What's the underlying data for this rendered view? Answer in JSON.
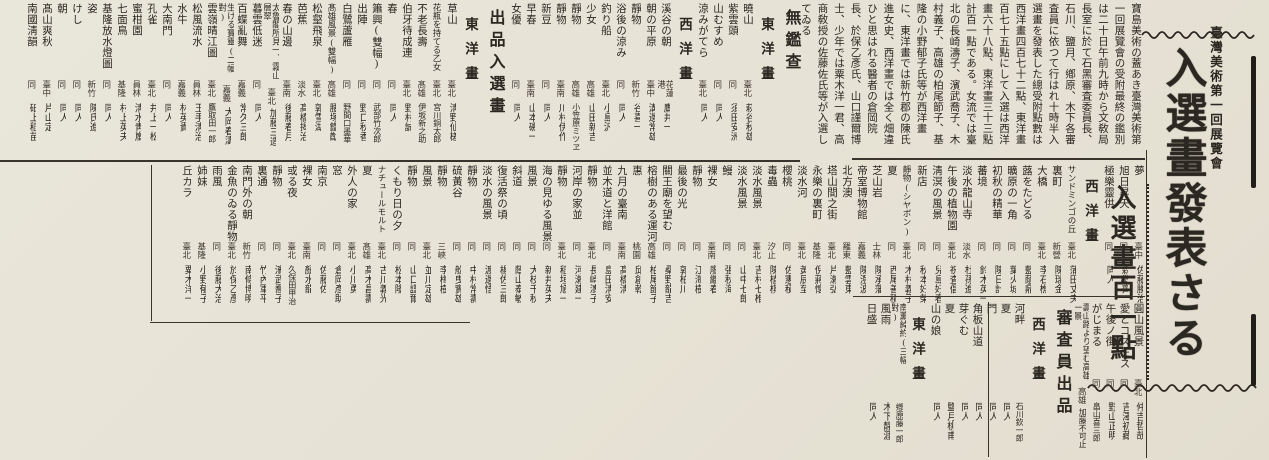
{
  "colors": {
    "paper": "#e8e4d8",
    "ink": "#2b2721"
  },
  "title_block": {
    "kicker": "臺灣美術第一回展覽會",
    "main_title": "入選畫發表さる",
    "sub_title": "入選畫百一點"
  },
  "lead": {
    "text": "寶島美術の蓋あき臺灣美術第一回展覽會の受附最終の鑑別は二十日午前九時から文敎局長室に於て石黑審査委員長、石川、鹽月、鄕原、木下各審査員に依つて行はれ十時半入選畫を發表した總受附點數は西洋畫四百七十二點、東洋畫百七十五點にして入選は西洋畫六十八點、東洋畫三十三點計百一點である。女流では臺北の長崎濤子、濱武喬子、木村義子、高雄の柏尾節子、基隆の小野郁子氏等が西洋畫に、東洋畫では新竹郡の陳氏進女史、西洋畫では全く畑違ひと思はれる醫者の倉岡院長、於保乙彥氏、山口謹爾博士、少年では粟木洋一君、高商敎授の佐藤佐氏等が入選してゐる"
  },
  "bands": {
    "top": [
      {
        "k": "h1",
        "text": "無鑑查"
      },
      {
        "k": "h2",
        "text": "東洋畫"
      },
      {
        "k": "e",
        "t": "曉山",
        "p": "臺北",
        "n": "萩谷秋雄"
      },
      {
        "k": "e",
        "t": "紫雲頭",
        "p": "同",
        "n": "須田安洲"
      },
      {
        "k": "e",
        "t": "山むすめ",
        "p": "同",
        "n": "同人"
      },
      {
        "k": "e",
        "t": "涼みがてら",
        "p": "臺北",
        "n": "同人"
      },
      {
        "k": "h2",
        "text": "西洋畫"
      },
      {
        "k": "e",
        "t": "溪谷の朝",
        "p": "花蓮港",
        "n": "鷹井一"
      },
      {
        "k": "e",
        "t": "朝の平原",
        "p": "臺中",
        "n": "溝邊常雄"
      },
      {
        "k": "e",
        "t": "靜物",
        "p": "新竹",
        "n": "谷喜一"
      },
      {
        "k": "e",
        "t": "浴後の涼み",
        "p": "同",
        "n": "同人"
      },
      {
        "k": "e",
        "t": "釣り船",
        "p": "臺北",
        "n": "小島汎"
      },
      {
        "k": "e",
        "t": "少女",
        "p": "高雄",
        "n": "山田新吉"
      },
      {
        "k": "e",
        "t": "靜物",
        "p": "高雄",
        "n": "小笠原ミツヱ"
      },
      {
        "k": "e",
        "t": "靜物",
        "p": "臺南",
        "n": "川村伊作"
      },
      {
        "k": "e",
        "t": "新豆",
        "p": "同",
        "n": "同人"
      },
      {
        "k": "e",
        "t": "早春",
        "p": "臺南",
        "n": "山本磯一"
      },
      {
        "k": "e",
        "t": "女優",
        "p": "同",
        "n": "同人"
      },
      {
        "k": "h1",
        "text": "出品入選畫"
      },
      {
        "k": "h2",
        "text": "東洋畫"
      },
      {
        "k": "e",
        "t": "草山",
        "p": "臺北",
        "n": "淸野仙槎"
      },
      {
        "k": "e",
        "t": "花瓶を持てる乙女",
        "p": "臺北",
        "n": "宮川銅太郎"
      },
      {
        "k": "e",
        "t": "不老長壽",
        "p": "髙雄",
        "n": "伊坂新之助"
      },
      {
        "k": "e",
        "t": "伯牙待成連",
        "p": "臺北",
        "n": "野村誠"
      },
      {
        "k": "e",
        "t": "春",
        "p": "同",
        "n": "同人"
      },
      {
        "k": "e",
        "t": "簫興(雙幅)",
        "p": "同",
        "n": "武部竹次郎"
      },
      {
        "k": "e",
        "t": "出陣",
        "p": "同",
        "n": "野口秋香"
      },
      {
        "k": "e",
        "t": "白鷺蘆雁",
        "p": "同",
        "n": "野間口墨華"
      },
      {
        "k": "e",
        "t": "髙雄風景(雙幅)",
        "p": "高雄",
        "n": "腰塚鐵猷"
      },
      {
        "k": "e",
        "t": "松壑飛泉",
        "p": "臺北",
        "n": "郭雪湖"
      },
      {
        "k": "e",
        "t": "芭蕉",
        "p": "淡水",
        "n": "髙橋揭治"
      },
      {
        "k": "e",
        "t": "春の山邊",
        "p": "臺南",
        "n": "後藤春月"
      },
      {
        "k": "e",
        "t": "太魯閣所見一、霧山層翠",
        "p": "臺北",
        "n": "加藤三造"
      },
      {
        "k": "e",
        "t": "暮雲低迷",
        "p": "同",
        "n": "同人"
      },
      {
        "k": "e",
        "t": "百蝶亂舞",
        "p": "嘉義",
        "n": "常久三郎"
      },
      {
        "k": "e",
        "t": "生ける寶靈(二幅對)",
        "p": "嘉義",
        "n": "大岡春濤"
      },
      {
        "k": "e",
        "t": "雲嶺晴江圖",
        "p": "臺北",
        "n": "鷹取田一郎"
      },
      {
        "k": "e",
        "t": "松風流水",
        "p": "員林",
        "n": "玉手淸治"
      },
      {
        "k": "e",
        "t": "水牛",
        "p": "嘉義",
        "n": "林英貴"
      },
      {
        "k": "e",
        "t": "大南門",
        "p": "同",
        "n": "同人"
      },
      {
        "k": "e",
        "t": "孔雀",
        "p": "臺北",
        "n": "井上一松"
      },
      {
        "k": "e",
        "t": "蜜柑園",
        "p": "員林",
        "n": "淸水靑嵐"
      },
      {
        "k": "e",
        "t": "七面鳥",
        "p": "基隆",
        "n": "村上英夫"
      },
      {
        "k": "e",
        "t": "基隆放水燈圖",
        "p": "同",
        "n": "同人"
      },
      {
        "k": "e",
        "t": "姿",
        "p": "新竹",
        "n": "陳氏進"
      },
      {
        "k": "e",
        "t": "けし",
        "p": "同",
        "n": "同人"
      },
      {
        "k": "e",
        "t": "朝",
        "p": "同",
        "n": "同人"
      },
      {
        "k": "e",
        "t": "髙山爽秋",
        "p": "臺中",
        "n": "片山定"
      },
      {
        "k": "e",
        "t": "南國淸韻",
        "p": "同",
        "n": "砥上稻苗"
      }
    ],
    "middle": [
      {
        "k": "e",
        "t": "夢",
        "p": "臺中",
        "n": "佐藤勝治"
      },
      {
        "k": "e",
        "t": "旭日昇天",
        "p": "同",
        "n": "森敎齊"
      },
      {
        "k": "e",
        "t": "極樂靈供",
        "p": "同",
        "n": "同人"
      },
      {
        "k": "h2",
        "text": "西洋畫"
      },
      {
        "k": "e",
        "t": "サンドミンゴの丘",
        "p": "臺北",
        "n": "蒲田丈夫"
      },
      {
        "k": "e",
        "t": "裏町",
        "p": "新營",
        "n": "陳瑞金"
      },
      {
        "k": "e",
        "t": "大橋",
        "p": "臺北",
        "n": "李石樵"
      },
      {
        "k": "e",
        "t": "蕗をたどる",
        "p": "同",
        "n": "藍蔭鼎"
      },
      {
        "k": "e",
        "t": "曠原の一角",
        "p": "同",
        "n": "葉火城"
      },
      {
        "k": "e",
        "t": "初秋の精華",
        "p": "同",
        "n": "陳日計"
      },
      {
        "k": "e",
        "t": "蕃境",
        "p": "同",
        "n": "鈴木英一"
      },
      {
        "k": "e",
        "t": "淡水龍山寺",
        "p": "淡水",
        "n": "杜孫進"
      },
      {
        "k": "e",
        "t": "午後の植物園",
        "p": "臺北",
        "n": "祝査倡"
      },
      {
        "k": "e",
        "t": "淸溟の風景",
        "p": "同",
        "n": "兒島好春"
      },
      {
        "k": "e",
        "t": "新店",
        "p": "同",
        "n": "秋本好榮"
      },
      {
        "k": "e",
        "t": "靜物(シヤボン)",
        "p": "臺北",
        "n": "木村義子"
      },
      {
        "k": "e",
        "t": "夏",
        "p": "同",
        "n": "西尾善積"
      },
      {
        "k": "e",
        "t": "芝山岩",
        "p": "士林",
        "n": "陳承藩"
      },
      {
        "k": "e",
        "t": "帝室博物館",
        "p": "嘉義",
        "n": "陳澄波"
      },
      {
        "k": "e",
        "t": "北方澳",
        "p": "羅東",
        "n": "藍雲東"
      },
      {
        "k": "e",
        "t": "塔山間之街",
        "p": "臺北",
        "n": "片瀨弘"
      },
      {
        "k": "e",
        "t": "永樂の裏町",
        "p": "基隆",
        "n": "倪蔣懷"
      },
      {
        "k": "e",
        "t": "淡水河",
        "p": "臺北",
        "n": "黃辰至"
      },
      {
        "k": "e",
        "t": "櫻桃",
        "p": "同",
        "n": "佐憲積"
      },
      {
        "k": "e",
        "t": "毒蟲",
        "p": "汐止",
        "n": "陳植棋"
      },
      {
        "k": "e",
        "t": "淡水風景",
        "p": "臺北",
        "n": "吉村七椎"
      },
      {
        "k": "e",
        "t": "淡水風景",
        "p": "同",
        "n": "山中七郎"
      },
      {
        "k": "e",
        "t": "鰻",
        "p": "同",
        "n": "張秋海"
      },
      {
        "k": "e",
        "t": "裸女",
        "p": "臺南",
        "n": "廖繼春"
      },
      {
        "k": "e",
        "t": "靜物",
        "p": "同",
        "n": "江海樹"
      },
      {
        "k": "e",
        "t": "最後の光",
        "p": "同",
        "n": "郭柏川"
      },
      {
        "k": "e",
        "t": "關王廟を望む",
        "p": "同",
        "n": "桑野龍吉"
      },
      {
        "k": "e",
        "t": "榕樹のある運河",
        "p": "高雄",
        "n": "柏尾節子"
      },
      {
        "k": "e",
        "t": "惠",
        "p": "桃園",
        "n": "邱創乾"
      },
      {
        "k": "e",
        "t": "九月の臺南",
        "p": "臺南",
        "n": "髙橋淸"
      },
      {
        "k": "e",
        "t": "並木道と洋館",
        "p": "同",
        "n": "島田淸安"
      },
      {
        "k": "e",
        "t": "靜物",
        "p": "臺北",
        "n": "長崎濤子"
      },
      {
        "k": "e",
        "t": "河岸の家並",
        "p": "同",
        "n": "河瀨建一"
      },
      {
        "k": "e",
        "t": "靜物",
        "p": "臺北",
        "n": "稻垣馗一"
      },
      {
        "k": "e",
        "t": "海の見ゆる風景",
        "p": "同",
        "n": "新井英夫"
      },
      {
        "k": "e",
        "t": "風景",
        "p": "同",
        "n": "大枝千秋"
      },
      {
        "k": "e",
        "t": "斜道",
        "p": "同",
        "n": "蔭山泰敏"
      },
      {
        "k": "e",
        "t": "復活祭の頃",
        "p": "同",
        "n": "楊佐三郎"
      },
      {
        "k": "e",
        "t": "淡水の風景",
        "p": "同",
        "n": "渡邊悟"
      },
      {
        "k": "e",
        "t": "靜物",
        "p": "同",
        "n": "中村常壽"
      },
      {
        "k": "e",
        "t": "硫黃谷",
        "p": "同",
        "n": "舩曳實雄"
      },
      {
        "k": "e",
        "t": "靜物",
        "p": "三峽",
        "n": "李梅樹"
      },
      {
        "k": "e",
        "t": "風景",
        "p": "臺北",
        "n": "並川定雄"
      },
      {
        "k": "e",
        "t": "靜物",
        "p": "同",
        "n": "山口謹爾"
      },
      {
        "k": "e",
        "t": "くもり日の夕",
        "p": "同",
        "n": "松本隆"
      },
      {
        "k": "e",
        "t": "ナチュールモルト",
        "p": "臺北",
        "n": "古川義光"
      },
      {
        "k": "e",
        "t": "夏",
        "p": "髙雄",
        "n": "髙木昌壽"
      },
      {
        "k": "e",
        "t": "外人の家",
        "p": "臺北",
        "n": "小川勇"
      },
      {
        "k": "e",
        "t": "窓",
        "p": "同",
        "n": "倉岡彥助"
      },
      {
        "k": "e",
        "t": "南京",
        "p": "同",
        "n": "佐藤佐"
      },
      {
        "k": "e",
        "t": "裸女",
        "p": "臺南",
        "n": "顏水龍"
      },
      {
        "k": "e",
        "t": "或る夜",
        "p": "臺北",
        "n": "久保田甲治"
      },
      {
        "k": "e",
        "t": "靜物",
        "p": "同",
        "n": "濱武喬子"
      },
      {
        "k": "e",
        "t": "裏通",
        "p": "同",
        "n": "竹內軍平"
      },
      {
        "k": "e",
        "t": "南門外の朝",
        "p": "新竹",
        "n": "南條博明"
      },
      {
        "k": "e",
        "t": "金魚のゐる靜物",
        "p": "臺北",
        "n": "於保乙彥"
      },
      {
        "k": "e",
        "t": "雨風",
        "p": "同",
        "n": "後藤大治"
      },
      {
        "k": "e",
        "t": "姉妹",
        "p": "基隆",
        "n": "小野郁子"
      },
      {
        "k": "e",
        "t": "丘カラ",
        "p": "臺北",
        "n": "粟木洋一"
      }
    ],
    "bottom": [
      {
        "k": "e",
        "t": "圓山風景",
        "p": "臺北",
        "n": "仲吉哲哉"
      },
      {
        "k": "e",
        "t": "愛とコスモス",
        "p": "同",
        "n": "吉澤初藏"
      },
      {
        "k": "e",
        "t": "午後ノ街",
        "p": "同",
        "n": "野山正明"
      },
      {
        "k": "e",
        "t": "がじまる",
        "p": "同",
        "n": "畠山喜三郎"
      },
      {
        "k": "e",
        "t": "壽山路より望む高雄一景",
        "p": "高雄",
        "n": "加藤不可止"
      },
      {
        "k": "h1",
        "text": "審査員出品"
      },
      {
        "k": "h2",
        "text": "西洋畫"
      },
      {
        "k": "e",
        "t": "河畔",
        "p": "",
        "n": "石川欽一郎"
      },
      {
        "k": "e",
        "t": "夏",
        "p": "",
        "n": "同人"
      },
      {
        "k": "e",
        "t": "門",
        "p": "",
        "n": "同人"
      },
      {
        "k": "e",
        "t": "角板山道",
        "p": "",
        "n": "同人"
      },
      {
        "k": "e",
        "t": "芽ぐむ",
        "p": "",
        "n": "同人"
      },
      {
        "k": "e",
        "t": "夏",
        "p": "",
        "n": "鹽月桃甫"
      },
      {
        "k": "e",
        "t": "山の娘",
        "p": "",
        "n": "同人"
      },
      {
        "k": "h2",
        "text": "東洋畫"
      },
      {
        "k": "e",
        "t": "南薰綽約(三幅對)",
        "p": "",
        "n": "鄕原藤一郎"
      },
      {
        "k": "e",
        "t": "風雨",
        "p": "",
        "n": "木下靜涯"
      },
      {
        "k": "e",
        "t": "日盛",
        "p": "",
        "n": "同人"
      }
    ]
  }
}
